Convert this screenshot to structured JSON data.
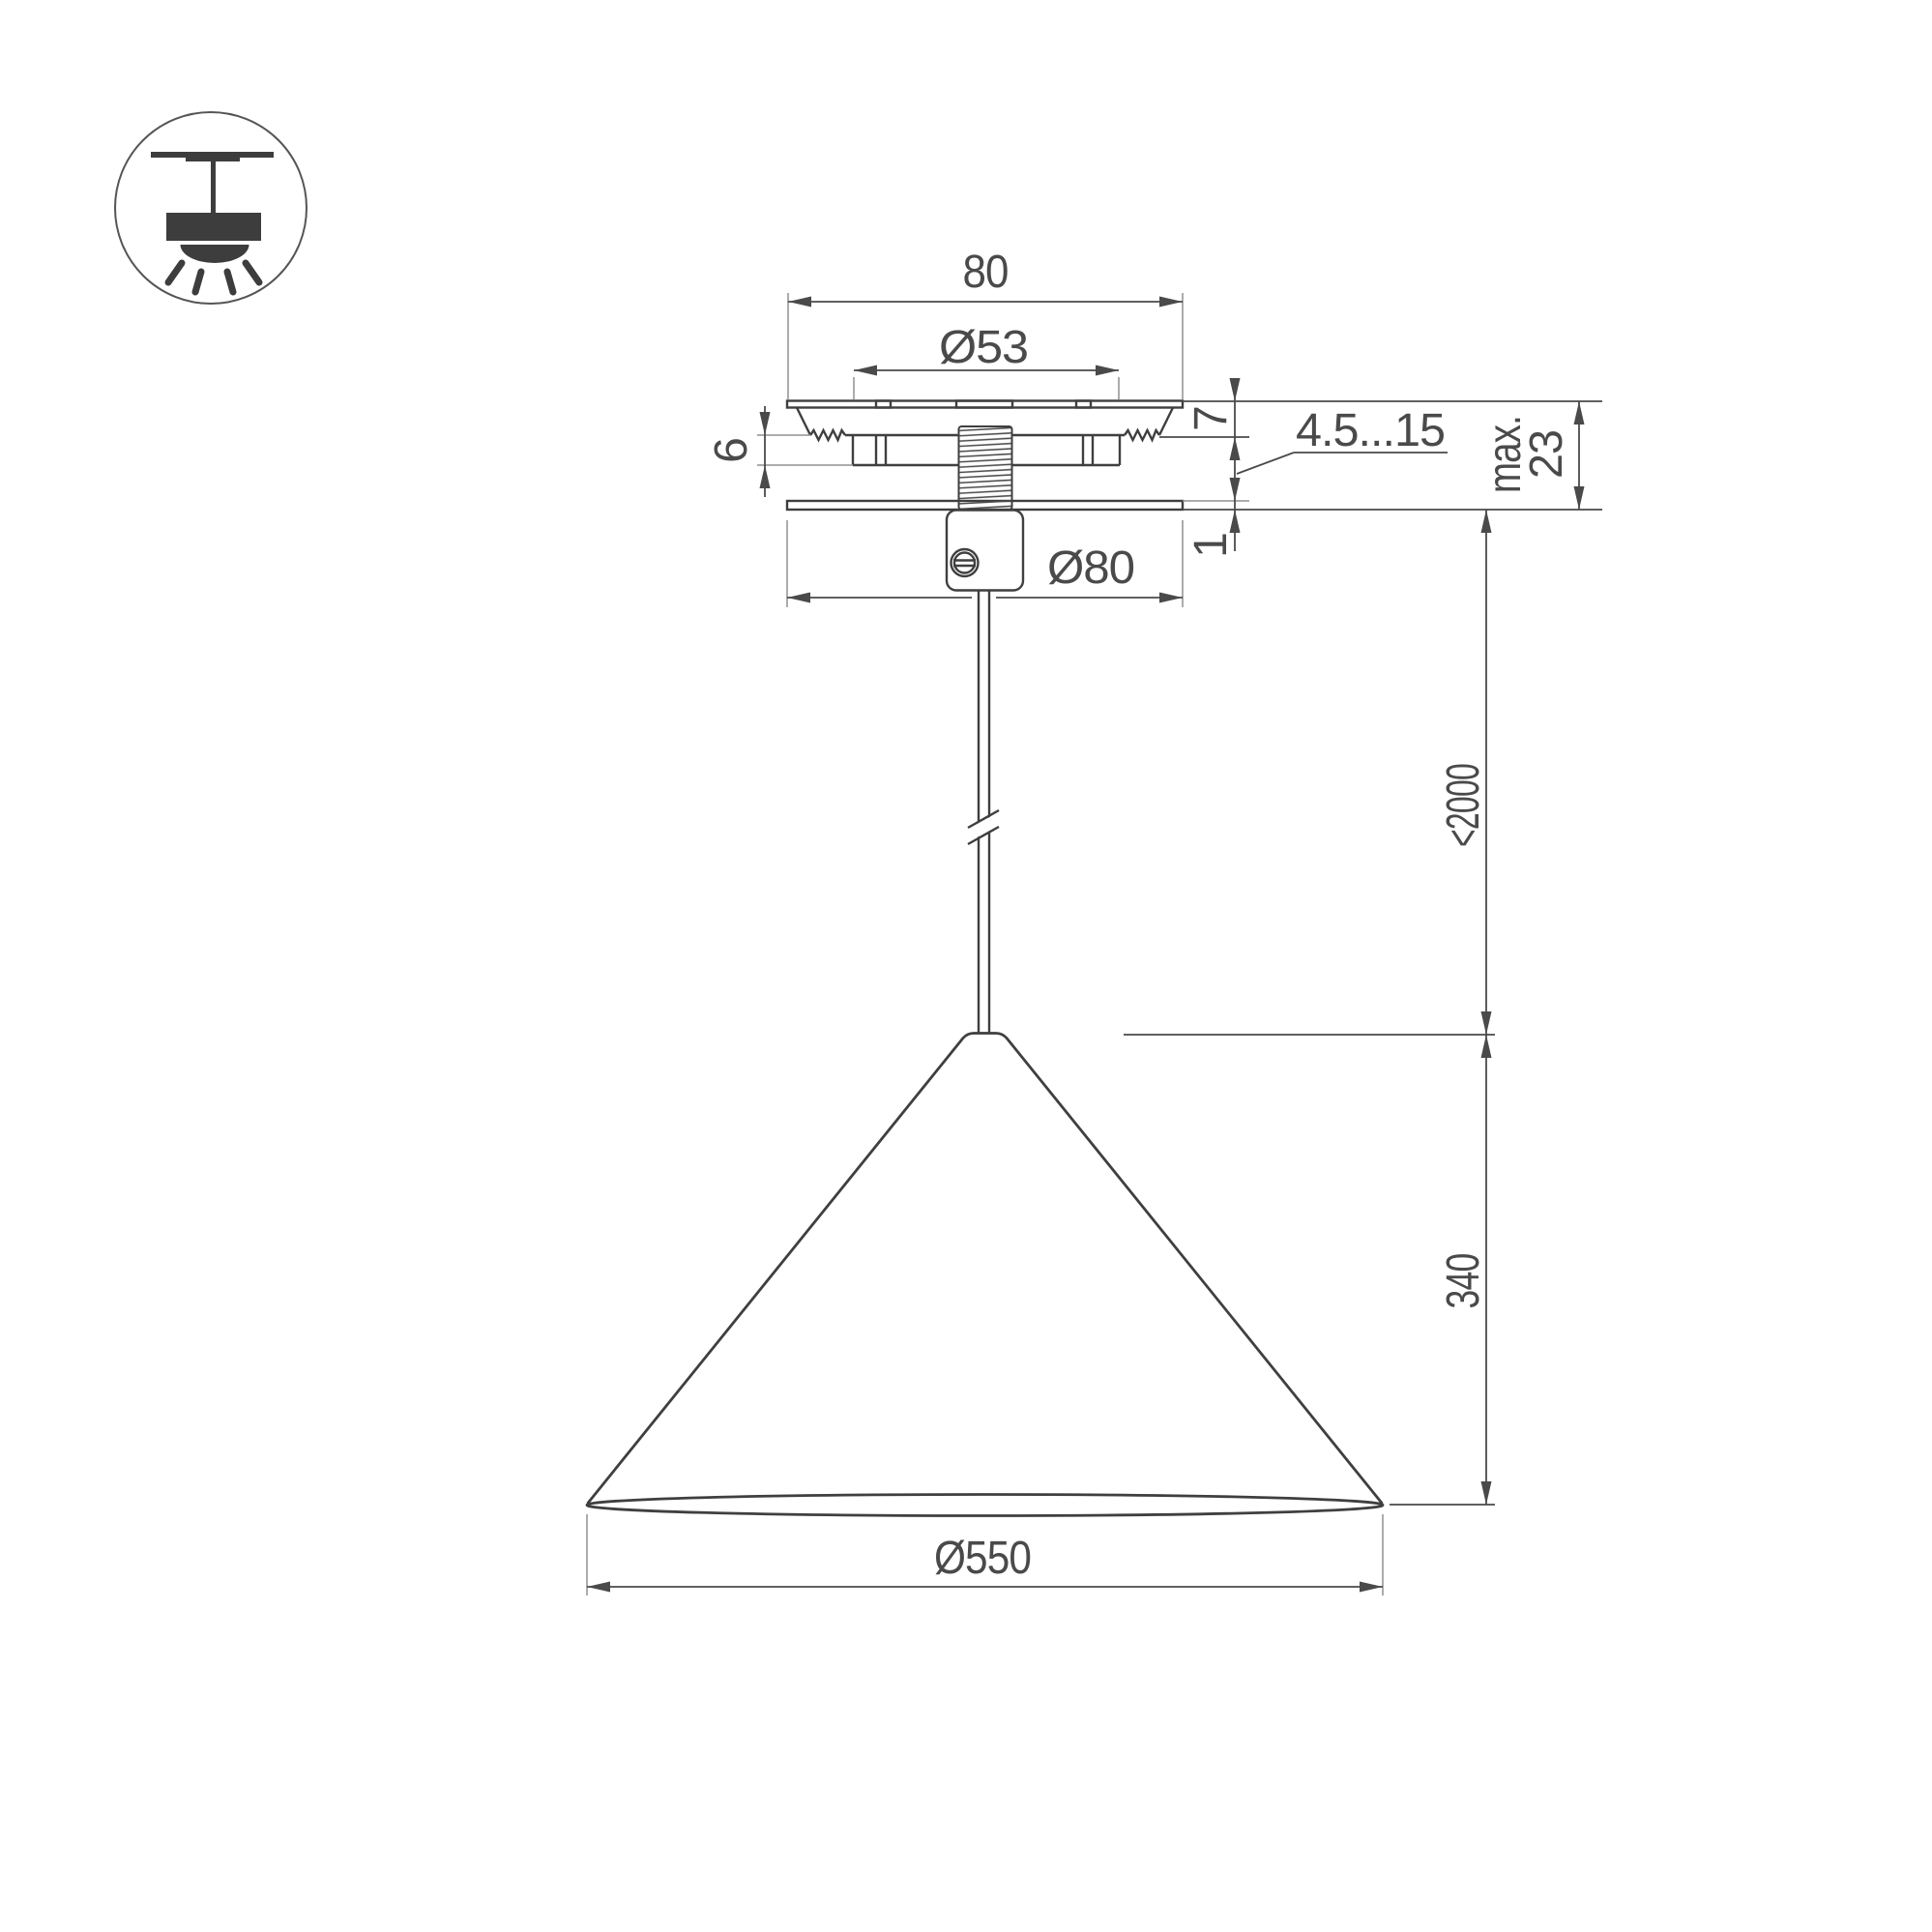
{
  "title": "Pendant luminaire installation drawing",
  "icon": {
    "pendant_mount_icon": "ceiling-pendant-lamp-symbol"
  },
  "dimensions": {
    "canopy_width": "80",
    "hole_diameter": "Ø53",
    "flange_height": "7",
    "clamp_height": "6",
    "grip_range": "4.5...15",
    "max_word": "max.",
    "max_value": "23",
    "plate_thickness": "1",
    "canopy_diameter": "Ø80",
    "suspension_length": "<2000",
    "shade_height": "340",
    "shade_diameter": "Ø550"
  },
  "colors": {
    "object_line": "#3f3f3f",
    "dimension_line": "#4a4a4a",
    "extension_line": "#909090",
    "background": "#ffffff"
  }
}
